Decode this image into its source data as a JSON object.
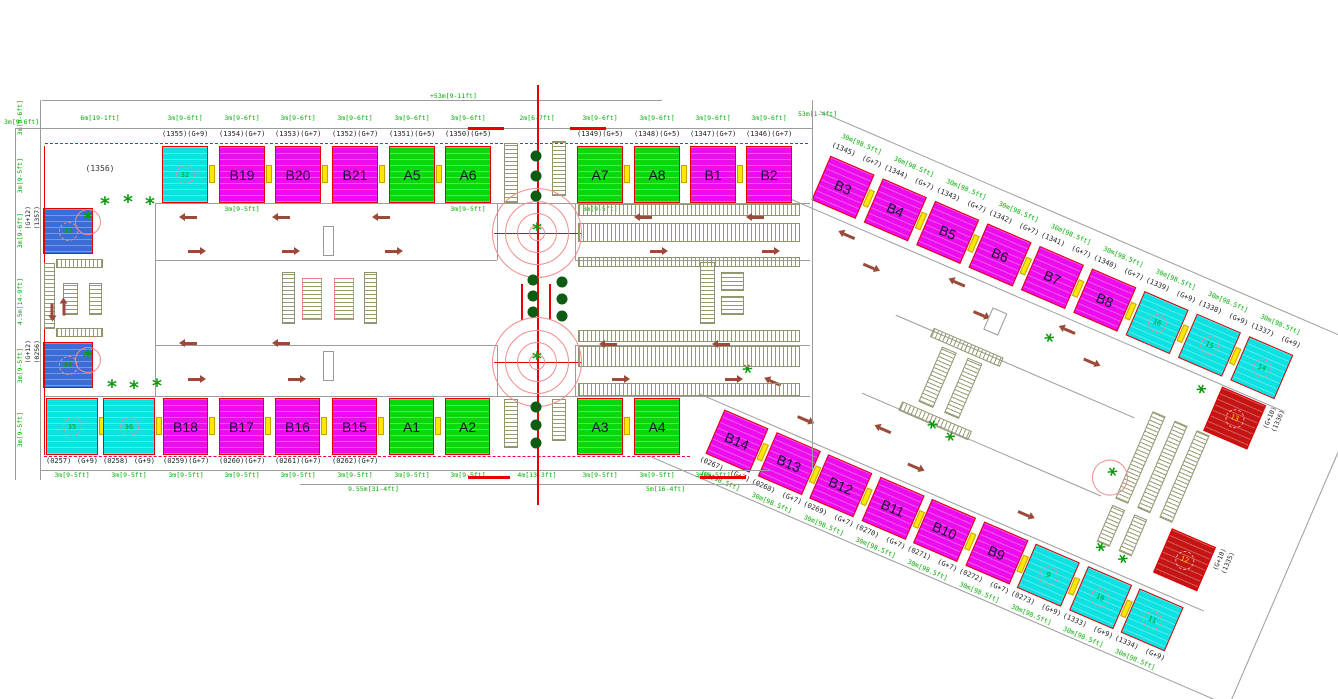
{
  "colors": {
    "magenta": "#ED0CED",
    "green": "#0BD80B",
    "cyan": "#0CE2E2",
    "blue": "#3C6CD6",
    "red": "#C41414",
    "dim_text": "#00AD00",
    "plot_text": "#1C1C1C",
    "line_red": "#E80000",
    "grid_gray": "#9C9C9C",
    "hatch": "#8F946E",
    "arrow_brown": "#9A4A38",
    "tree_green": "#0C9A0C",
    "yellow_connector": "#FFE800"
  },
  "left_complex": {
    "top_dims": [
      "6m[19-1ft]",
      "3m[9-6ft]",
      "3m[9-6ft]",
      "3m[9-6ft]",
      "3m[9-6ft]",
      "3m[9-6ft]",
      "3m[9-6ft]",
      "2m[6-7ft]",
      "3m[9-6ft]",
      "3m[9-6ft]",
      "3m[9-6ft]",
      "3m[9-6ft]"
    ],
    "top_row": [
      {
        "plot": "(1355)",
        "floors": "(G+9)",
        "label": "32",
        "color": "cyan",
        "circled": true
      },
      {
        "plot": "(1354)",
        "floors": "(G+7)",
        "label": "B19",
        "color": "magenta"
      },
      {
        "plot": "(1353)",
        "floors": "(G+7)",
        "label": "B20",
        "color": "magenta"
      },
      {
        "plot": "(1352)",
        "floors": "(G+7)",
        "label": "B21",
        "color": "magenta"
      },
      {
        "plot": "(1351)",
        "floors": "(G+5)",
        "label": "A5",
        "color": "green"
      },
      {
        "plot": "(1350)",
        "floors": "(G+5)",
        "label": "A6",
        "color": "green"
      },
      {
        "plot": "(1349)",
        "floors": "(G+5)",
        "label": "A7",
        "color": "green"
      },
      {
        "plot": "(1348)",
        "floors": "(G+5)",
        "label": "A8",
        "color": "green"
      },
      {
        "plot": "(1347)",
        "floors": "(G+7)",
        "label": "B1",
        "color": "magenta"
      },
      {
        "plot": "(1346)",
        "floors": "(G+7)",
        "label": "B2",
        "color": "magenta"
      }
    ],
    "bottom_row": [
      {
        "plot": "(0257)",
        "floors": "(G+9)",
        "label": "35",
        "color": "cyan",
        "circled": true
      },
      {
        "plot": "(0258)",
        "floors": "(G+9)",
        "label": "36",
        "color": "cyan",
        "circled": true
      },
      {
        "plot": "(0259)",
        "floors": "(G+7)",
        "label": "B18",
        "color": "magenta"
      },
      {
        "plot": "(0260)",
        "floors": "(G+7)",
        "label": "B17",
        "color": "magenta"
      },
      {
        "plot": "(0261)",
        "floors": "(G+7)",
        "label": "B16",
        "color": "magenta"
      },
      {
        "plot": "(0262)",
        "floors": "(G+7)",
        "label": "B15",
        "color": "magenta"
      },
      {
        "plot": "",
        "floors": "",
        "label": "A1",
        "color": "green"
      },
      {
        "plot": "",
        "floors": "",
        "label": "A2",
        "color": "green"
      },
      {
        "plot": "",
        "floors": "",
        "label": "A3",
        "color": "green"
      },
      {
        "plot": "",
        "floors": "",
        "label": "A4",
        "color": "green"
      }
    ],
    "bottom_dims": [
      "3m[9-5ft]",
      "3m[9-5ft]",
      "3m[9-5ft]",
      "3m[9-5ft]",
      "3m[9-5ft]",
      "3m[9-5ft]",
      "3m[9-5ft]",
      "3m[9-5ft]",
      "4m[13-3ft]",
      "3m[9-5ft]",
      "3m[9-5ft]",
      "3m[9-5ft]"
    ],
    "inner_dims": [
      "3m[9-5ft]",
      "3m[9-5ft]",
      "3m[9-5ft]"
    ],
    "left_col": {
      "empty_plot": "(1356)",
      "blocks": [
        {
          "plot": "(1357)",
          "floors": "(G+12)",
          "label": "33",
          "color": "blue",
          "circled": true
        },
        {
          "plot": "(0256)",
          "floors": "(G+12)",
          "label": "34",
          "color": "blue",
          "circled": true
        }
      ],
      "side_dims": [
        "3m[9-6ft]",
        "3m[9-5ft]",
        "3m[9-6ft]",
        "4.5m[14-9ft]",
        "3m[9-5ft]",
        "3m[9-5ft]"
      ],
      "corner_dim": "3m[9-6ft]"
    },
    "totals": {
      "top": "+53m[9-11ft]",
      "top_right": "53m[1-4ft]",
      "bottom": "9.55m[31-4ft]",
      "bottom_right": "5m[16-4ft]"
    }
  },
  "right_complex": {
    "edge_dim": "30m[98.5ft]",
    "top_row": [
      {
        "plot": "(1345)",
        "floors": "(G+7)",
        "label": "B3",
        "color": "magenta"
      },
      {
        "plot": "(1344)",
        "floors": "(G+7)",
        "label": "B4",
        "color": "magenta"
      },
      {
        "plot": "(1343)",
        "floors": "(G+7)",
        "label": "B5",
        "color": "magenta"
      },
      {
        "plot": "(1342)",
        "floors": "(G+7)",
        "label": "B6",
        "color": "magenta"
      },
      {
        "plot": "(1341)",
        "floors": "(G+7)",
        "label": "B7",
        "color": "magenta"
      },
      {
        "plot": "(1340)",
        "floors": "(G+7)",
        "label": "B8",
        "color": "magenta"
      },
      {
        "plot": "(1339)",
        "floors": "(G+9)",
        "label": "16",
        "color": "cyan",
        "circled": true
      },
      {
        "plot": "(1338)",
        "floors": "(G+9)",
        "label": "15",
        "color": "cyan",
        "circled": true
      },
      {
        "plot": "(1337)",
        "floors": "(G+9)",
        "label": "14",
        "color": "cyan",
        "circled": true
      }
    ],
    "top_red": {
      "plot": "(1336)",
      "floors": "(G+10)",
      "label": "13",
      "color": "red",
      "circled": true
    },
    "bottom_row": [
      {
        "plot": "(0267)",
        "floors": "(G+7)",
        "label": "B14",
        "color": "magenta"
      },
      {
        "plot": "(0268)",
        "floors": "(G+7)",
        "label": "B13",
        "color": "magenta"
      },
      {
        "plot": "(0269)",
        "floors": "(G+7)",
        "label": "B12",
        "color": "magenta"
      },
      {
        "plot": "(0270)",
        "floors": "(G+7)",
        "label": "B11",
        "color": "magenta"
      },
      {
        "plot": "(0271)",
        "floors": "(G+7)",
        "label": "B10",
        "color": "magenta"
      },
      {
        "plot": "(0272)",
        "floors": "(G+7)",
        "label": "B9",
        "color": "magenta"
      },
      {
        "plot": "(0273)",
        "floors": "(G+9)",
        "label": "9",
        "color": "cyan",
        "circled": true
      },
      {
        "plot": "(1333)",
        "floors": "(G+9)",
        "label": "10",
        "color": "cyan",
        "circled": true
      },
      {
        "plot": "(1334)",
        "floors": "(G+9)",
        "label": "11",
        "color": "cyan",
        "circled": true
      }
    ],
    "bottom_red": {
      "plot": "(1335)",
      "floors": "(G+10)",
      "label": "12",
      "color": "red",
      "circled": true
    }
  }
}
